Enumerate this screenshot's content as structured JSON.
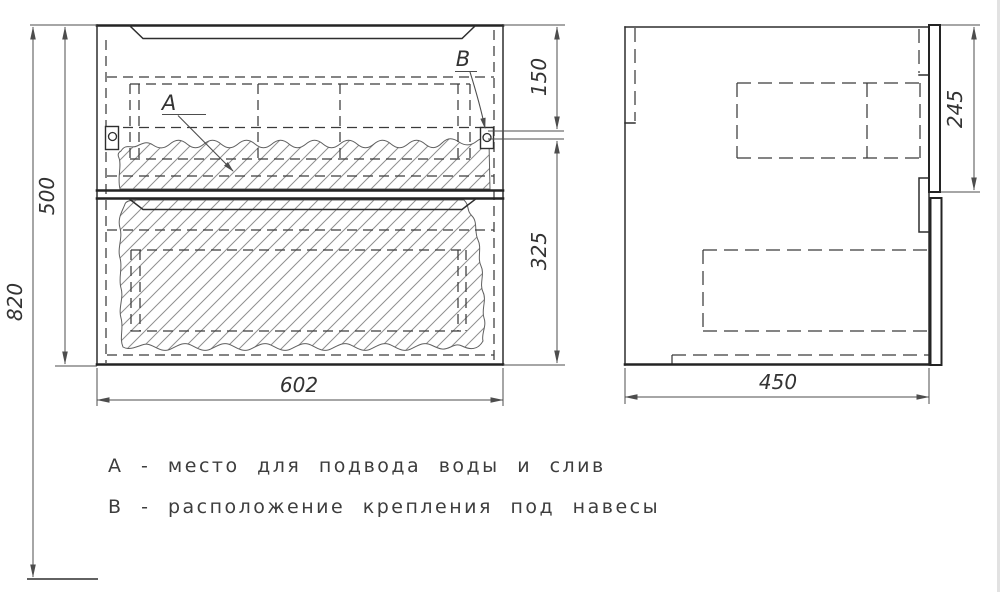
{
  "drawing": {
    "title": "vanity-cabinet-technical-drawing",
    "views": {
      "front": "front-view-two-drawers",
      "side": "side-view"
    },
    "labels": {
      "a": "А",
      "b": "В"
    },
    "legend": {
      "line_a": "А - место для подвода воды и слив",
      "line_b": "В - расположение крепления под навесы"
    },
    "dims": {
      "overall_height": "820",
      "carcass_height": "500",
      "width": "602",
      "depth": "450",
      "hanger_from_top": "150",
      "hanger_to_bottom": "325",
      "drawer_front_height": "245"
    },
    "colors": {
      "line": "#2e2e2e",
      "dimension": "#4d4d4d",
      "hatch": "#8f8f8f",
      "background": "#ffffff"
    }
  }
}
